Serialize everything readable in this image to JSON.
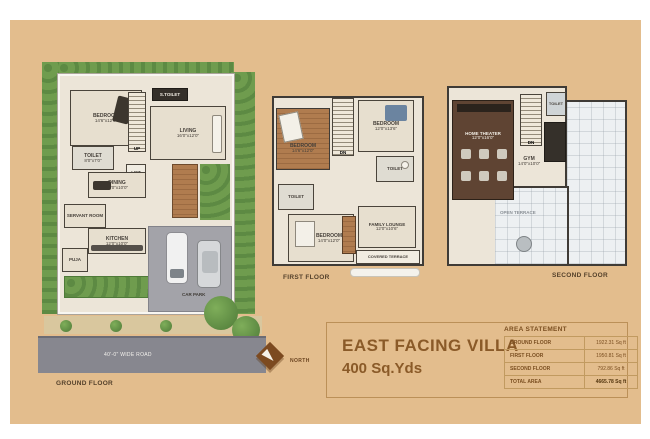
{
  "title_block": {
    "title": "EAST FACING VILLA",
    "subtitle": "400 Sq.Yds"
  },
  "compass": {
    "label": "NORTH"
  },
  "area_statement": {
    "heading": "AREA STATEMENT",
    "rows": [
      {
        "label": "GROUND FLOOR",
        "value": "1922.31 Sq ft"
      },
      {
        "label": "FIRST FLOOR",
        "value": "1950.81 Sq ft"
      },
      {
        "label": "SECOND FLOOR",
        "value": "792.86 Sq ft"
      },
      {
        "label": "TOTAL AREA",
        "value": "4665.78 Sq ft"
      }
    ]
  },
  "ground_floor": {
    "caption": "GROUND FLOOR",
    "road_label": "40'-0\" WIDE ROAD",
    "rooms": {
      "bedroom": {
        "name": "BEDROOM",
        "dims": "14'6\"x12'0\""
      },
      "toilet": {
        "name": "TOILET",
        "dims": "8'0\"x7'0\""
      },
      "s_toilet": {
        "name": "S.TOILET"
      },
      "stairs": {
        "name": "UP"
      },
      "living": {
        "name": "LIVING",
        "dims": "16'0\"x12'0\""
      },
      "lift": {
        "name": "LIFT"
      },
      "dining": {
        "name": "DINING",
        "dims": "12'0\"x10'0\""
      },
      "servant": {
        "name": "SERVANT ROOM"
      },
      "kitchen": {
        "name": "KITCHEN",
        "dims": "12'0\"x10'0\""
      },
      "puja": {
        "name": "PUJA"
      },
      "car_park": {
        "name": "CAR PARK"
      }
    }
  },
  "first_floor": {
    "caption": "FIRST FLOOR",
    "rooms": {
      "bedroom_1": {
        "name": "BEDROOM",
        "dims": "14'6\"x12'0\""
      },
      "bedroom_2": {
        "name": "BEDROOM",
        "dims": "12'0\"x13'6\""
      },
      "bedroom_3": {
        "name": "BEDROOM",
        "dims": "14'0\"x12'0\""
      },
      "toilet_1": {
        "name": "TOILET"
      },
      "toilet_2": {
        "name": "TOILET"
      },
      "family_lounge": {
        "name": "FAMILY LOUNGE",
        "dims": "12'0\"x10'6\""
      },
      "covered_terrace": {
        "name": "COVERED TERRACE"
      },
      "stairs": {
        "name": "DN"
      }
    }
  },
  "second_floor": {
    "caption": "SECOND FLOOR",
    "rooms": {
      "home_theater": {
        "name": "HOME THEATER",
        "dims": "12'0\"x16'0\""
      },
      "gym": {
        "name": "GYM",
        "dims": "14'0\"x10'0\""
      },
      "toilet": {
        "name": "TOILET"
      },
      "open_terrace": {
        "name": "OPEN TERRACE"
      },
      "stairs": {
        "name": "DN"
      }
    }
  }
}
